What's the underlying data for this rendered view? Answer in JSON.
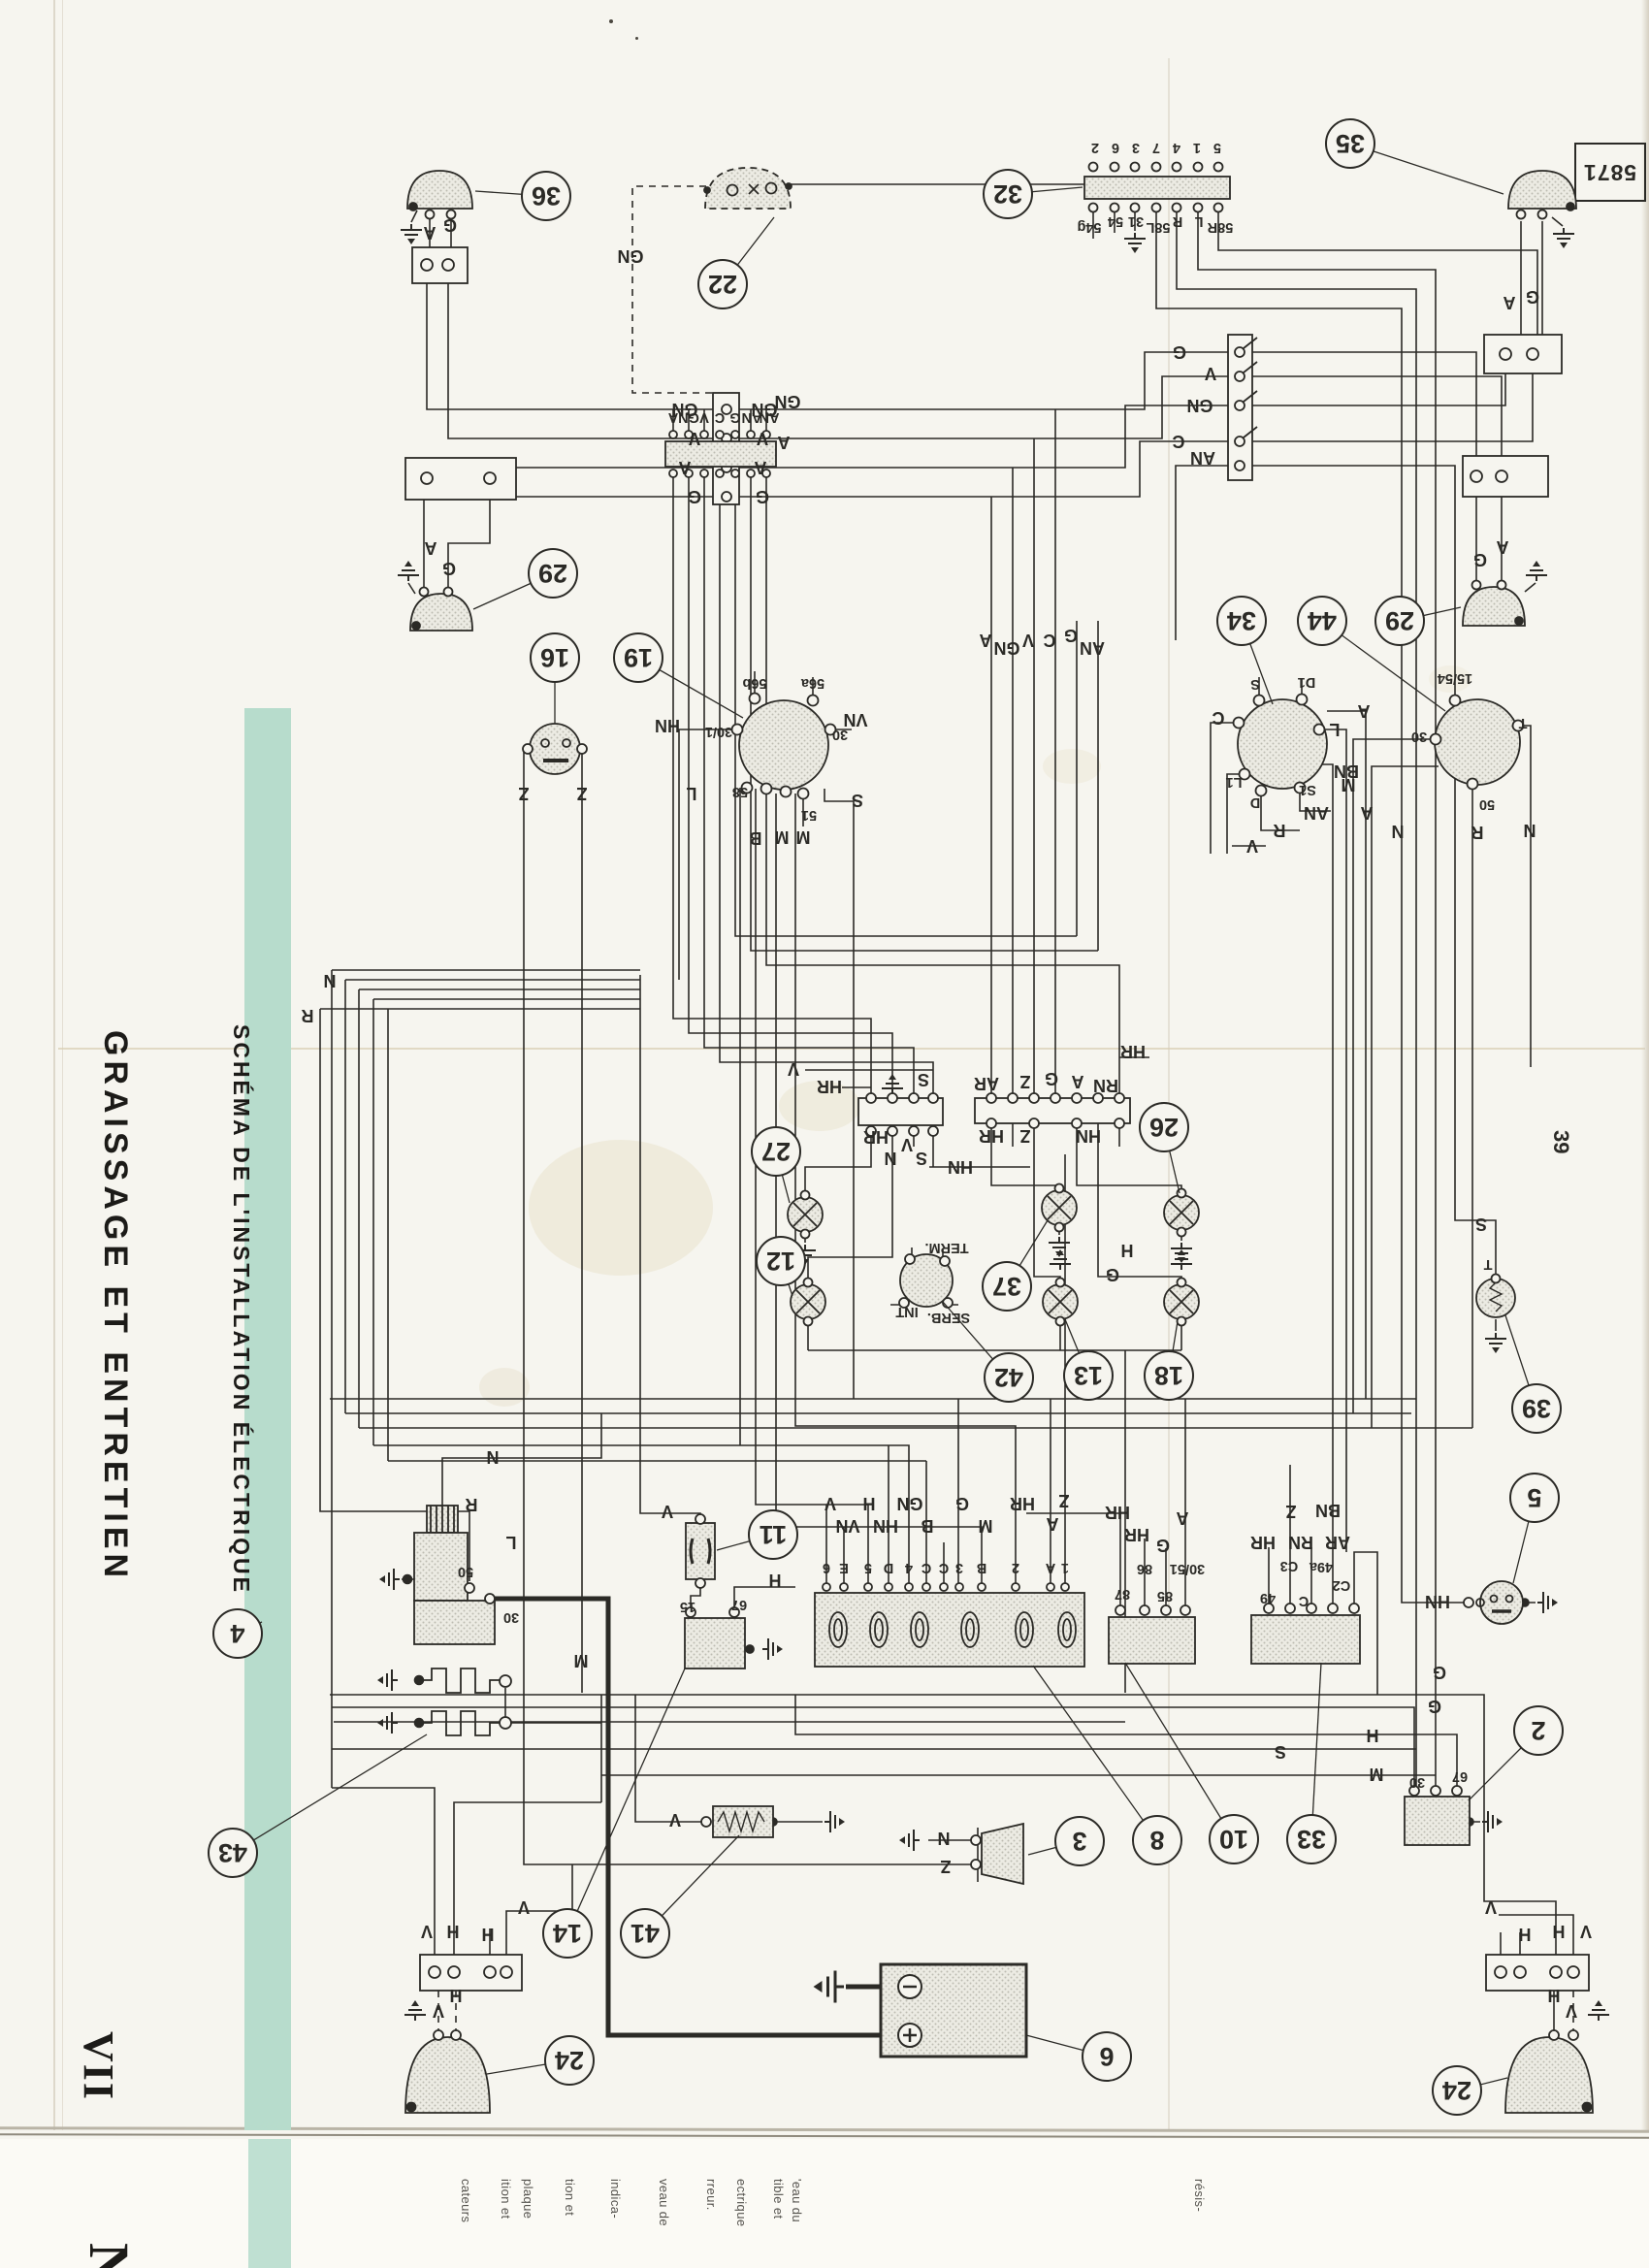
{
  "page": {
    "number": "39",
    "stamp": "5871"
  },
  "sidebar": {
    "chapter_numeral": "VII",
    "chapter_title": "GRAISSAGE ET ENTRETIEN",
    "band_title": "SCHÉMA DE L'INSTALLATION ÉLECTRIQUE",
    "band_color": "#b7dccc",
    "next_page_partial_letter": "N"
  },
  "underpage_fragments": [
    [
      "cateurs",
      481
    ],
    [
      "ition et",
      522
    ],
    [
      "plaque",
      545
    ],
    [
      "tion et",
      588
    ],
    [
      "indica-",
      635
    ],
    [
      "veau de",
      685
    ],
    [
      "rreur.",
      734
    ],
    [
      "ectrique",
      765
    ],
    [
      "tible et",
      803
    ],
    [
      "'eau du",
      822
    ],
    [
      "résis-",
      1237
    ]
  ],
  "diagram": {
    "ink": "#2b2a26",
    "callouts": [
      [
        "36",
        563,
        202,
        490,
        197
      ],
      [
        "22",
        745,
        293,
        798,
        224
      ],
      [
        "32",
        1039,
        200,
        1116,
        193
      ],
      [
        "35",
        1392,
        148,
        1550,
        200
      ],
      [
        "29",
        570,
        591,
        488,
        628
      ],
      [
        "16",
        572,
        678,
        572,
        746
      ],
      [
        "19",
        658,
        678,
        766,
        740
      ],
      [
        "34",
        1280,
        640,
        1312,
        726
      ],
      [
        "44",
        1363,
        640,
        1490,
        733
      ],
      [
        "29",
        1443,
        640,
        1506,
        626
      ],
      [
        "27",
        800,
        1187,
        814,
        1240
      ],
      [
        "12",
        805,
        1300,
        817,
        1336
      ],
      [
        "37",
        1038,
        1326,
        1080,
        1258
      ],
      [
        "42",
        1040,
        1420,
        972,
        1342
      ],
      [
        "13",
        1122,
        1418,
        1098,
        1360
      ],
      [
        "18",
        1205,
        1418,
        1214,
        1362
      ],
      [
        "26",
        1200,
        1162,
        1216,
        1230
      ],
      [
        "39",
        1584,
        1452,
        1552,
        1356
      ],
      [
        "4",
        245,
        1684,
        270,
        1672
      ],
      [
        "43",
        240,
        1910,
        440,
        1788
      ],
      [
        "11",
        797,
        1582,
        739,
        1598
      ],
      [
        "14",
        585,
        1993,
        706,
        1720
      ],
      [
        "41",
        665,
        1993,
        762,
        1892
      ],
      [
        "3",
        1113,
        1898,
        1060,
        1912
      ],
      [
        "8",
        1193,
        1897,
        1065,
        1717
      ],
      [
        "10",
        1272,
        1896,
        1160,
        1714
      ],
      [
        "33",
        1352,
        1896,
        1362,
        1714
      ],
      [
        "2",
        1586,
        1784,
        1514,
        1856
      ],
      [
        "5",
        1582,
        1544,
        1560,
        1632
      ],
      [
        "6",
        1141,
        2120,
        1058,
        2098
      ],
      [
        "24",
        587,
        2124,
        502,
        2138
      ],
      [
        "24",
        1502,
        2155,
        1554,
        2142
      ]
    ],
    "labels": [
      [
        "A",
        443,
        240,
        "w"
      ],
      [
        "G",
        464,
        232,
        "w"
      ],
      [
        "GN",
        650,
        264,
        "w"
      ],
      [
        "2",
        1129,
        152,
        "t"
      ],
      [
        "6",
        1150,
        152,
        "t"
      ],
      [
        "3",
        1171,
        152,
        "t"
      ],
      [
        "7",
        1192,
        152,
        "t"
      ],
      [
        "4",
        1213,
        152,
        "t"
      ],
      [
        "1",
        1234,
        152,
        "t"
      ],
      [
        "5",
        1255,
        152,
        "t"
      ],
      [
        "54g",
        1123,
        234,
        "t"
      ],
      [
        "54",
        1150,
        228,
        "t"
      ],
      [
        "31",
        1171,
        228,
        "t"
      ],
      [
        "58L",
        1194,
        234,
        "t"
      ],
      [
        "R",
        1214,
        228,
        "t"
      ],
      [
        "L",
        1236,
        228,
        "t"
      ],
      [
        "58R",
        1258,
        234,
        "t"
      ],
      [
        "A",
        1556,
        312,
        "w"
      ],
      [
        "G",
        1580,
        306,
        "w"
      ],
      [
        "G",
        1526,
        577,
        "w"
      ],
      [
        "A",
        1549,
        564,
        "w"
      ],
      [
        "A",
        444,
        565,
        "w"
      ],
      [
        "G",
        463,
        586,
        "w"
      ],
      [
        "GN",
        706,
        422,
        "w"
      ],
      [
        "V",
        716,
        452,
        "w"
      ],
      [
        "A",
        706,
        482,
        "w"
      ],
      [
        "G",
        716,
        512,
        "w"
      ],
      [
        "GN",
        788,
        422,
        "w"
      ],
      [
        "V",
        786,
        452,
        "w"
      ],
      [
        "A",
        784,
        482,
        "w"
      ],
      [
        "G",
        786,
        512,
        "w"
      ],
      [
        "G",
        1216,
        363,
        "w"
      ],
      [
        "V",
        1248,
        385,
        "w"
      ],
      [
        "GN",
        1237,
        418,
        "w"
      ],
      [
        "C",
        1215,
        455,
        "w"
      ],
      [
        "AN",
        1240,
        472,
        "w"
      ],
      [
        "GN",
        812,
        414,
        "w"
      ],
      [
        "A",
        808,
        456,
        "w"
      ],
      [
        "A",
        694,
        430,
        "t"
      ],
      [
        "GN",
        710,
        430,
        "t"
      ],
      [
        "V",
        726,
        430,
        "t"
      ],
      [
        "C",
        742,
        430,
        "t"
      ],
      [
        "G",
        758,
        430,
        "t"
      ],
      [
        "AN",
        775,
        430,
        "t"
      ],
      [
        "AN",
        793,
        430,
        "t"
      ],
      [
        "A",
        1016,
        660,
        "w"
      ],
      [
        "GN",
        1038,
        668,
        "w"
      ],
      [
        "V",
        1060,
        660,
        "w"
      ],
      [
        "C",
        1082,
        660,
        "w"
      ],
      [
        "G",
        1104,
        655,
        "w"
      ],
      [
        "AN",
        1126,
        668,
        "w"
      ],
      [
        "HN",
        688,
        748,
        "w"
      ],
      [
        "56b",
        778,
        704,
        "t"
      ],
      [
        "56a",
        838,
        704,
        "t"
      ],
      [
        "30/1",
        741,
        754,
        "t"
      ],
      [
        "30",
        866,
        757,
        "t"
      ],
      [
        "VN",
        882,
        742,
        "w"
      ],
      [
        "58",
        763,
        816,
        "t"
      ],
      [
        "L",
        713,
        818,
        "w"
      ],
      [
        "51",
        834,
        840,
        "t"
      ],
      [
        "S",
        884,
        825,
        "w"
      ],
      [
        "B",
        779,
        864,
        "w"
      ],
      [
        "M",
        806,
        863,
        "w"
      ],
      [
        "M",
        828,
        863,
        "w"
      ],
      [
        "Z",
        540,
        818,
        "w"
      ],
      [
        "Z",
        600,
        818,
        "w"
      ],
      [
        "S",
        1294,
        705,
        "t"
      ],
      [
        "D1",
        1347,
        703,
        "t"
      ],
      [
        "C",
        1256,
        740,
        "w"
      ],
      [
        "L1",
        1272,
        806,
        "t"
      ],
      [
        "D",
        1294,
        827,
        "t"
      ],
      [
        "S1",
        1348,
        814,
        "t"
      ],
      [
        "AN",
        1357,
        838,
        "w"
      ],
      [
        "R",
        1319,
        856,
        "w"
      ],
      [
        "V",
        1291,
        872,
        "w"
      ],
      [
        "BN",
        1388,
        795,
        "w"
      ],
      [
        "L",
        1376,
        752,
        "w"
      ],
      [
        "A",
        1406,
        733,
        "w"
      ],
      [
        "15/54",
        1500,
        699,
        "t"
      ],
      [
        "30",
        1463,
        759,
        "t"
      ],
      [
        "M",
        1390,
        809,
        "w"
      ],
      [
        "A",
        1409,
        838,
        "w"
      ],
      [
        "N",
        1441,
        857,
        "w"
      ],
      [
        "50",
        1533,
        829,
        "t"
      ],
      [
        "R",
        1523,
        858,
        "w"
      ],
      [
        "N",
        1577,
        856,
        "w"
      ],
      [
        "T",
        1570,
        745,
        "t"
      ],
      [
        "V",
        818,
        1102,
        "w"
      ],
      [
        "HR",
        855,
        1120,
        "w"
      ],
      [
        "S",
        952,
        1113,
        "w"
      ],
      [
        "HR",
        903,
        1172,
        "w"
      ],
      [
        "V",
        935,
        1180,
        "w"
      ],
      [
        "N",
        918,
        1194,
        "w"
      ],
      [
        "S",
        950,
        1194,
        "w"
      ],
      [
        "HN",
        990,
        1203,
        "w"
      ],
      [
        "HR",
        1168,
        1084,
        "w"
      ],
      [
        "AR",
        1017,
        1117,
        "w"
      ],
      [
        "Z",
        1057,
        1115,
        "w"
      ],
      [
        "G",
        1084,
        1112,
        "w"
      ],
      [
        "A",
        1111,
        1115,
        "w"
      ],
      [
        "RN",
        1140,
        1119,
        "w"
      ],
      [
        "HR",
        1022,
        1171,
        "w"
      ],
      [
        "Z",
        1057,
        1171,
        "w"
      ],
      [
        "HN",
        1122,
        1171,
        "w"
      ],
      [
        "H",
        1162,
        1289,
        "w"
      ],
      [
        "G",
        1147,
        1314,
        "w"
      ],
      [
        "TERM.",
        976,
        1286,
        "t"
      ],
      [
        "INT",
        935,
        1352,
        "t"
      ],
      [
        "SERB.",
        978,
        1358,
        "t"
      ],
      [
        "N",
        340,
        1011,
        "w"
      ],
      [
        "R",
        317,
        1047,
        "w"
      ],
      [
        "N",
        508,
        1502,
        "w"
      ],
      [
        "R",
        486,
        1551,
        "w"
      ],
      [
        "L",
        527,
        1590,
        "w"
      ],
      [
        "50",
        480,
        1620,
        "t"
      ],
      [
        "30",
        527,
        1667,
        "t"
      ],
      [
        "M",
        599,
        1712,
        "w"
      ],
      [
        "V",
        688,
        1558,
        "w"
      ],
      [
        "15",
        709,
        1656,
        "t"
      ],
      [
        "67",
        762,
        1654,
        "t"
      ],
      [
        "H",
        799,
        1629,
        "w"
      ],
      [
        "V",
        696,
        1876,
        "w"
      ],
      [
        "V",
        856,
        1550,
        "w"
      ],
      [
        "VN",
        874,
        1573,
        "w"
      ],
      [
        "H",
        896,
        1550,
        "w"
      ],
      [
        "HN",
        913,
        1573,
        "w"
      ],
      [
        "GN",
        938,
        1550,
        "w"
      ],
      [
        "B",
        956,
        1573,
        "w"
      ],
      [
        "G",
        992,
        1550,
        "w"
      ],
      [
        "M",
        1016,
        1573,
        "w"
      ],
      [
        "HR",
        1054,
        1550,
        "w"
      ],
      [
        "Z",
        1097,
        1547,
        "w"
      ],
      [
        "A",
        1085,
        1571,
        "w"
      ],
      [
        "6",
        852,
        1616,
        "t"
      ],
      [
        "E",
        870,
        1616,
        "t"
      ],
      [
        "5",
        895,
        1616,
        "t"
      ],
      [
        "D",
        916,
        1616,
        "t"
      ],
      [
        "4",
        937,
        1616,
        "t"
      ],
      [
        "C",
        955,
        1616,
        "t"
      ],
      [
        "C",
        973,
        1616,
        "t"
      ],
      [
        "3",
        989,
        1616,
        "t"
      ],
      [
        "B",
        1012,
        1616,
        "t"
      ],
      [
        "2",
        1047,
        1616,
        "t"
      ],
      [
        "A",
        1083,
        1616,
        "t"
      ],
      [
        "1",
        1098,
        1616,
        "t"
      ],
      [
        "HR",
        1152,
        1559,
        "w"
      ],
      [
        "HR",
        1172,
        1582,
        "w"
      ],
      [
        "G",
        1199,
        1593,
        "w"
      ],
      [
        "A",
        1219,
        1565,
        "w"
      ],
      [
        "87",
        1157,
        1643,
        "t"
      ],
      [
        "86",
        1180,
        1617,
        "t"
      ],
      [
        "85",
        1201,
        1645,
        "t"
      ],
      [
        "30/51",
        1224,
        1617,
        "t"
      ],
      [
        "Z",
        1331,
        1558,
        "w"
      ],
      [
        "BN",
        1369,
        1557,
        "w"
      ],
      [
        "HR",
        1302,
        1590,
        "w"
      ],
      [
        "RN",
        1341,
        1590,
        "w"
      ],
      [
        "AR",
        1379,
        1590,
        "w"
      ],
      [
        "49",
        1307,
        1647,
        "t"
      ],
      [
        "C",
        1344,
        1650,
        "t"
      ],
      [
        "C3",
        1329,
        1614,
        "t"
      ],
      [
        "49a",
        1362,
        1615,
        "t"
      ],
      [
        "C2",
        1383,
        1634,
        "t"
      ],
      [
        "30",
        1461,
        1837,
        "t"
      ],
      [
        "67",
        1505,
        1831,
        "t"
      ],
      [
        "M",
        1419,
        1829,
        "w"
      ],
      [
        "S",
        1320,
        1806,
        "w"
      ],
      [
        "H",
        1415,
        1789,
        "w"
      ],
      [
        "G",
        1479,
        1759,
        "w"
      ],
      [
        "G",
        1484,
        1724,
        "w"
      ],
      [
        "N",
        973,
        1895,
        "w"
      ],
      [
        "Z",
        975,
        1924,
        "w"
      ],
      [
        "HN",
        1482,
        1651,
        "w"
      ],
      [
        "S",
        1527,
        1262,
        "w"
      ],
      [
        "T",
        1534,
        1303,
        "t"
      ],
      [
        "V",
        440,
        1991,
        "w"
      ],
      [
        "H",
        467,
        1991,
        "w"
      ],
      [
        "H",
        503,
        1994,
        "w"
      ],
      [
        "V",
        540,
        1966,
        "w"
      ],
      [
        "V",
        452,
        2073,
        "w"
      ],
      [
        "H",
        470,
        2057,
        "w"
      ],
      [
        "V",
        1635,
        1991,
        "w"
      ],
      [
        "H",
        1607,
        1991,
        "w"
      ],
      [
        "H",
        1572,
        1994,
        "w"
      ],
      [
        "V",
        1537,
        1966,
        "w"
      ],
      [
        "V",
        1620,
        2073,
        "w"
      ],
      [
        "H",
        1602,
        2057,
        "w"
      ]
    ]
  }
}
